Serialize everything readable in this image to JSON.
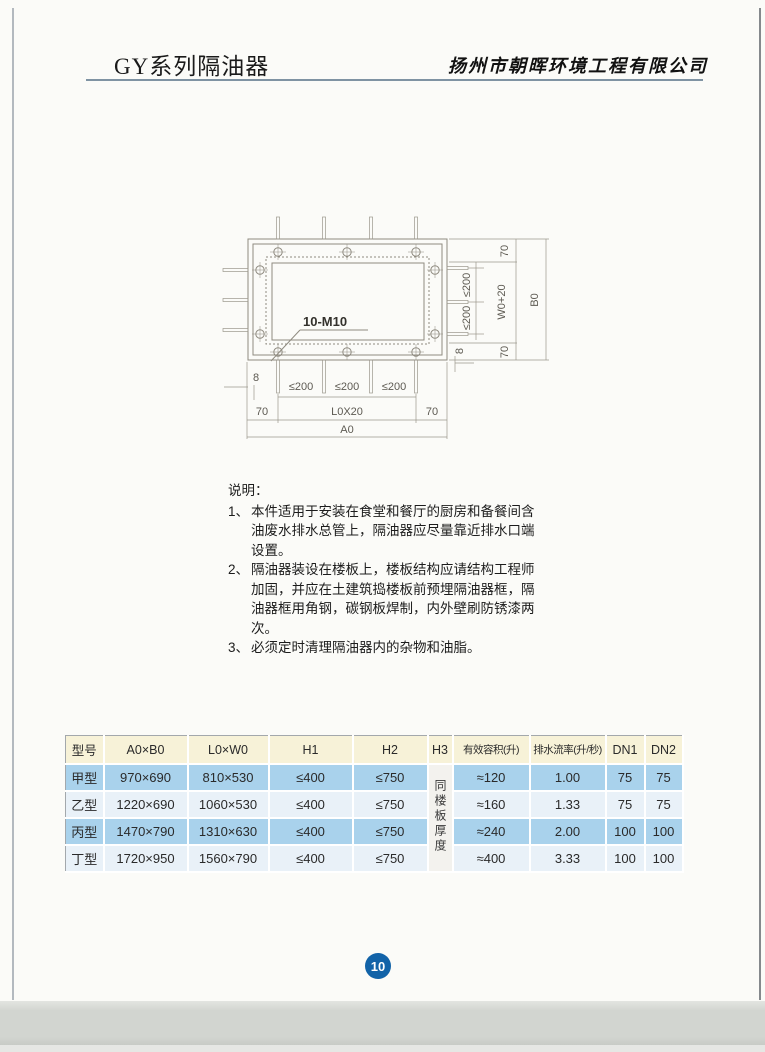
{
  "header": {
    "title": "GY系列隔油器",
    "company": "扬州市朝晖环境工程有限公司"
  },
  "diagram": {
    "labels": {
      "bolt": "10-M10",
      "le200": "≤200",
      "d70": "70",
      "d8": "8",
      "l0x20": "L0X20",
      "a0": "A0",
      "w0p20": "W0+20",
      "b0": "B0"
    }
  },
  "notes": {
    "heading": "说明：",
    "items": [
      {
        "num": "1、",
        "text": "本件适用于安装在食堂和餐厅的厨房和备餐间含油废水排水总管上，隔油器应尽量靠近排水口端设置。"
      },
      {
        "num": "2、",
        "text": "隔油器装设在楼板上，楼板结构应请结构工程师加固，并应在土建筑捣楼板前预埋隔油器框，隔油器框用角钢，碳钢板焊制，内外壁刷防锈漆两次。"
      },
      {
        "num": "3、",
        "text": "必须定时清理隔油器内的杂物和油脂。"
      }
    ]
  },
  "table": {
    "headers": [
      "型号",
      "A0×B0",
      "L0×W0",
      "H1",
      "H2",
      "H3",
      "有效容积(升)",
      "排水流率(升/秒)",
      "DN1",
      "DN2"
    ],
    "h3_note": "同楼板厚度",
    "rows": [
      {
        "model": "甲型",
        "a0b0": "970×690",
        "l0w0": "810×530",
        "h1": "≤400",
        "h2": "≤750",
        "volume": "≈120",
        "flow": "1.00",
        "dn1": "75",
        "dn2": "75"
      },
      {
        "model": "乙型",
        "a0b0": "1220×690",
        "l0w0": "1060×530",
        "h1": "≤400",
        "h2": "≤750",
        "volume": "≈160",
        "flow": "1.33",
        "dn1": "75",
        "dn2": "75"
      },
      {
        "model": "丙型",
        "a0b0": "1470×790",
        "l0w0": "1310×630",
        "h1": "≤400",
        "h2": "≤750",
        "volume": "≈240",
        "flow": "2.00",
        "dn1": "100",
        "dn2": "100"
      },
      {
        "model": "丁型",
        "a0b0": "1720×950",
        "l0w0": "1560×790",
        "h1": "≤400",
        "h2": "≤750",
        "volume": "≈400",
        "flow": "3.33",
        "dn1": "100",
        "dn2": "100"
      }
    ]
  },
  "page_number": "10",
  "colors": {
    "accent_blue": "#1263a8",
    "table_header_cream": "#f7f2d8",
    "table_row_blue": "#a9d2ec",
    "table_row_light": "#e9f1f8",
    "header_rule": "#7f93a3"
  }
}
